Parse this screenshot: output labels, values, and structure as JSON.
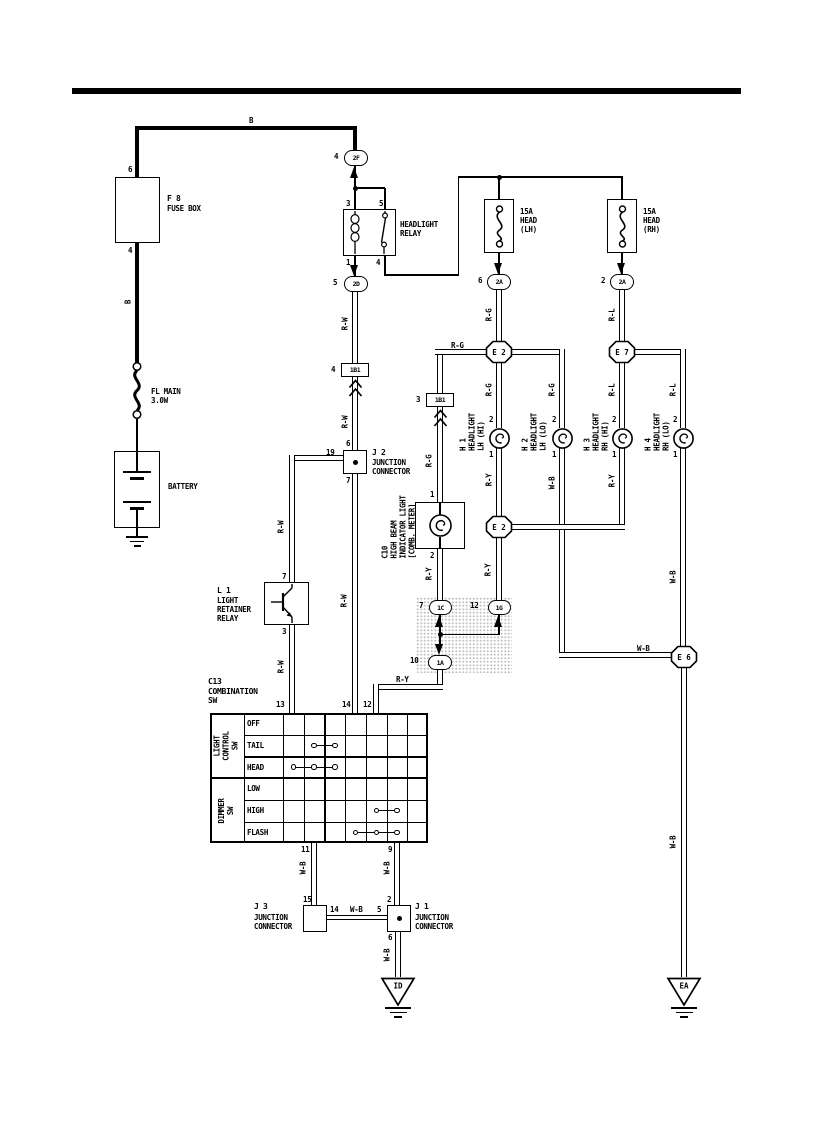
{
  "diagram": {
    "power": {
      "fusebox_pin_top": "6",
      "fusebox_pin_bottom": "4",
      "fusebox_name": "F 8",
      "fusebox_label": "FUSE BOX",
      "fl_name": "FL MAIN",
      "fl_rating": "3.0W",
      "battery": "BATTERY"
    },
    "relay": {
      "name": "HEADLIGHT\nRELAY",
      "pin3": "3",
      "pin5": "5",
      "pin1": "1",
      "pin4": "4"
    },
    "fuses": {
      "lh": "15A\nHEAD\n(LH)",
      "rh": "15A\nHEAD\n(RH)"
    },
    "connectors": {
      "c2f": {
        "pin": "4",
        "code": "2F"
      },
      "c2d": {
        "pin": "5",
        "code": "2D"
      },
      "c2a_lh": {
        "pin": "6",
        "code": "2A"
      },
      "c2a_rh": {
        "pin": "2",
        "code": "2A"
      },
      "c1b1_a": {
        "pin": "4",
        "code": "1B1"
      },
      "c1b1_b": {
        "pin": "3",
        "code": "1B1"
      },
      "c1c": {
        "pin": "7",
        "code": "1C"
      },
      "c1g": {
        "pin": "12",
        "code": "1G"
      },
      "c1a": {
        "pin": "10",
        "code": "1A"
      },
      "e2_upper": "E 2",
      "e7": "E 7",
      "e2_lower": "E 2",
      "e6": "E 6"
    },
    "j2": {
      "name": "J 2",
      "label": "JUNCTION\nCONNECTOR",
      "pin_top": "6",
      "pin_left": "19",
      "pin_bottom": "7"
    },
    "j3": {
      "name": "J 3",
      "label": "JUNCTION\nCONNECTOR",
      "pin_top": "15",
      "pin_right": "14"
    },
    "j1": {
      "name": "J 1",
      "label": "JUNCTION\nCONNECTOR",
      "pin_top": "2",
      "pin_left": "5",
      "pin_bottom": "6"
    },
    "l1": {
      "name": "L 1",
      "label": "LIGHT\nRETAINER\nRELAY",
      "pin_top": "7",
      "pin_bottom": "3"
    },
    "c10": {
      "label": "C10\nHIGH BEAM\nINDICATOR LIGHT\n[COMB. METER]",
      "pin_top": "1",
      "pin_bottom": "2"
    },
    "headlights": [
      {
        "label": "H 1\nHEADLIGHT\nLH (HI)",
        "pin_top": "2",
        "pin_bottom": "1"
      },
      {
        "label": "H 2\nHEADLIGHT\nLH (LO)",
        "pin_top": "2",
        "pin_bottom": "1"
      },
      {
        "label": "H 3\nHEADLIGHT\nRH (HI)",
        "pin_top": "2",
        "pin_bottom": "1"
      },
      {
        "label": "H 4\nHEADLIGHT\nRH (LO)",
        "pin_top": "2",
        "pin_bottom": "1"
      }
    ],
    "comb_switch": {
      "name": "C13\nCOMBINATION\nSW",
      "group1": "LIGHT\nCONTROL\nSW",
      "group2": "DIMMER\nSW",
      "rows": [
        "OFF",
        "TAIL",
        "HEAD",
        "LOW",
        "HIGH",
        "FLASH"
      ],
      "pins_top": [
        "13",
        "14",
        "12"
      ],
      "pins_bottom": [
        "11",
        "9"
      ],
      "contacts": [
        {
          "row": "TAIL",
          "cols": [
            2,
            3
          ]
        },
        {
          "row": "HEAD",
          "cols": [
            1,
            2,
            3
          ]
        },
        {
          "row": "HIGH",
          "cols": [
            5,
            6
          ]
        },
        {
          "row": "FLASH",
          "cols": [
            4,
            5,
            6
          ]
        }
      ]
    },
    "grounds": {
      "id": "ID",
      "ea": "EA"
    },
    "wire_labels": {
      "b_top": "B",
      "b_side": "B",
      "rw_1": "R-W",
      "rw_2": "R-W",
      "rw_3": "R-W",
      "rw_4": "R-W",
      "rw_5": "R-W",
      "rg_drop": "R-G",
      "rl_drop": "R-L",
      "rg_branch": "R-G",
      "rg_c10": "R-G",
      "rg_h1": "R-G",
      "rg_h2": "R-G",
      "rl_h3": "R-L",
      "rl_h4": "R-L",
      "ry_h1": "R-Y",
      "ry_h3": "R-Y",
      "ry_e2": "R-Y",
      "ry_c10": "R-Y",
      "ry_sw": "R-Y",
      "wb_h2": "W-B",
      "wb_h4": "W-B",
      "wb_e6": "W-B",
      "wb_ea": "W-B",
      "wb_sw11": "W-B",
      "wb_sw9": "W-B",
      "wb_j3j1": "W-B",
      "wb_id": "W-B"
    }
  }
}
